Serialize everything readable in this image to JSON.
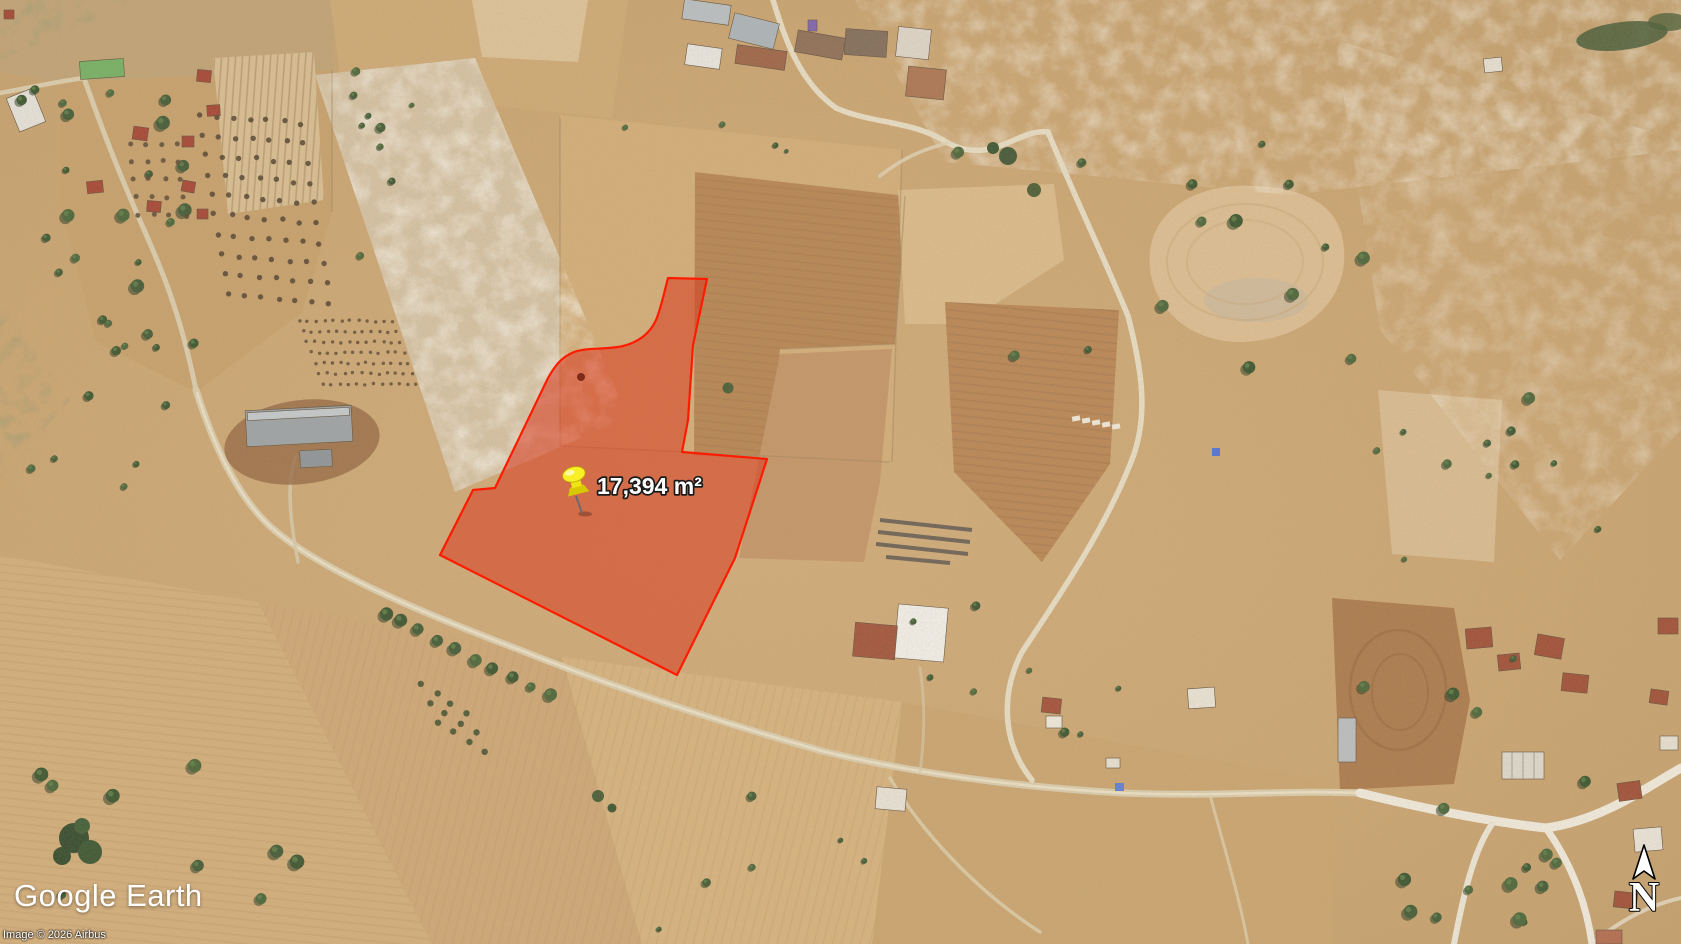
{
  "branding": {
    "logo": "Google Earth"
  },
  "attribution": {
    "line": "Image © 2026 Airbus"
  },
  "overlay": {
    "area_label": "17,394 m²",
    "parcel_fill": "#d93a20",
    "parcel_stroke": "#ff1b00",
    "pin_color": "#f6ec22",
    "pin_icon": "yellow-pushpin-icon"
  },
  "compass": {
    "north_label": "N"
  }
}
